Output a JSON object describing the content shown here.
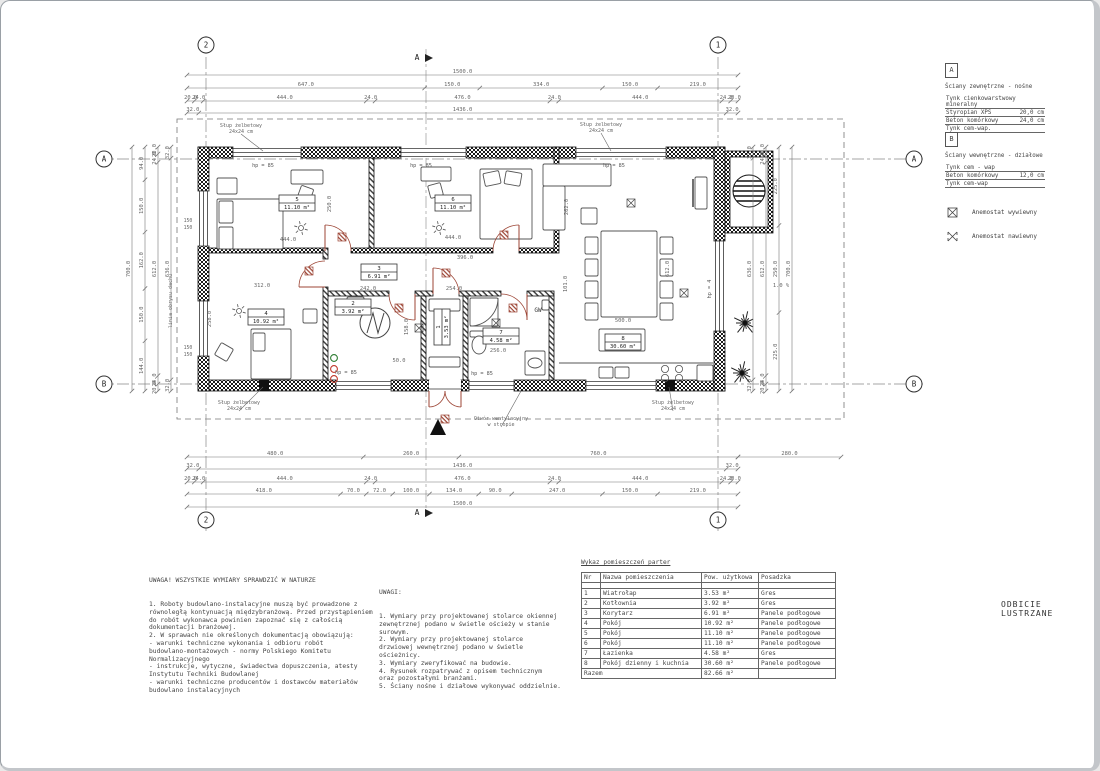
{
  "sheet": {
    "mirror_note": "ODBICIE LUSTRZANE"
  },
  "axes": {
    "col_left": "2",
    "col_right": "1",
    "row_top": "A",
    "row_bottom": "B",
    "section": "A"
  },
  "legend": {
    "wall_type_a": {
      "letter": "A",
      "title": "Ściany zewnętrzne - nośne",
      "layers": [
        {
          "name": "Tynk cienkowarstwowy mineralny",
          "value": ""
        },
        {
          "name": "Styropian XPS",
          "value": "20,0 cm"
        },
        {
          "name": "Beton komórkowy",
          "value": "24,0 cm"
        },
        {
          "name": "Tynk cem-wap.",
          "value": ""
        }
      ]
    },
    "wall_type_b": {
      "letter": "B",
      "title": "Ściany wewnętrzne - działowe",
      "layers": [
        {
          "name": "Tynk cem - wap",
          "value": ""
        },
        {
          "name": "Beton komórkowy",
          "value": "12,0 cm"
        },
        {
          "name": "Tynk cem-wap",
          "value": ""
        }
      ]
    },
    "symbols": [
      {
        "label": "Anemostat wywiewny"
      },
      {
        "label": "Anemostat nawiewny"
      }
    ]
  },
  "dims": {
    "top": [
      [
        "1500.0"
      ],
      [
        "647.0",
        "150.0",
        "334.0",
        "150.0",
        "219.0"
      ],
      [
        "20.0",
        "24.0",
        "444.0",
        "24.0",
        "476.0",
        "24.0",
        "444.0",
        "24.0",
        "20.0"
      ],
      [
        "32.0",
        "1436.0",
        "32.0"
      ]
    ],
    "bottom": [
      [
        "480.0",
        "260.0",
        "760.0"
      ],
      [
        "32.0",
        "1436.0",
        "32.0"
      ],
      [
        "20.0",
        "24.0",
        "444.0",
        "24.0",
        "476.0",
        "24.0",
        "444.0",
        "24.0",
        "20.0"
      ],
      [
        "418.0",
        "70.0",
        "72.0",
        "100.0",
        "134.0",
        "90.0",
        "247.0",
        "150.0",
        "219.0"
      ],
      [
        "1500.0"
      ]
    ],
    "bottom_ext": [
      "280.0"
    ],
    "left": [
      [
        "700.0"
      ],
      [
        "94.0",
        "150.0",
        "162.0",
        "150.0",
        "144.0"
      ],
      [
        "20.0",
        "24.0",
        "612.0",
        "24.0",
        "20.0"
      ],
      [
        "32.0",
        "636.0",
        "32.0"
      ]
    ],
    "right": [
      [
        "32.0",
        "636.0",
        "32.0"
      ],
      [
        "20.0",
        "24.0",
        "612.0",
        "24.0",
        "20.0"
      ],
      [
        "225.0",
        "250.0",
        "225.0"
      ],
      [
        "700.0"
      ]
    ]
  },
  "interior_dims": [
    "444.0",
    "250.0",
    "444.0",
    "396.0",
    "312.0",
    "258.0",
    "242.0",
    "254.0",
    "158.0",
    "256.0",
    "262.0",
    "612.0",
    "101.0",
    "500.0",
    "50.0"
  ],
  "hp_labels": [
    "hp = 85",
    "hp = 85",
    "hp = 85",
    "hp = 85",
    "hp = 85",
    "hp = 4"
  ],
  "window_tags": [
    "150",
    "150",
    "150",
    "150"
  ],
  "callouts": {
    "column": [
      "Słup żelbetowy",
      "24x24 cm"
    ],
    "vent": [
      "Otwór wentylacyjny",
      "w stropie"
    ],
    "roof_line": "linia obrysu dachu",
    "slope": "1.0 %",
    "gas_water": "GW"
  },
  "notes_left": {
    "title": "UWAGA! WSZYSTKIE WYMIARY SPRAWDZIĆ W NATURZE",
    "lines": [
      "1. Roboty budowlano-instalacyjne muszą być prowadzone z",
      "równoległą kontynuacją międzybranżową. Przed przystąpieniem",
      "do robót wykonawca powinien zapoznać się z całością",
      "dokumentacji branżowej.",
      "2. W sprawach nie określonych dokumentacją obowiązują:",
      "- warunki techniczne wykonania i odbioru robót",
      "budowlano-montażowych - normy Polskiego Komitetu",
      "Normalizacyjnego",
      "- instrukcje, wytyczne, świadectwa dopuszczenia, atesty",
      "Instytutu Techniki Budowlanej",
      "- warunki techniczne producentów i dostawców materiałów",
      "budowlano instalacyjnych"
    ]
  },
  "notes_center": {
    "title": "UWAGI:",
    "lines": [
      "1. Wymiary przy projektowanej stolarce okiennej",
      "zewnętrznej podano w świetle ościeży w stanie",
      "surowym.",
      "2. Wymiary przy projektowanej stolarce",
      "drzwiowej wewnętrznej podano w świetle",
      "ościeżnicy.",
      "3. Wymiary zweryfikować na budowie.",
      "4. Rysunek rozpatrywać z opisem technicznym",
      "oraz pozostałymi branżami.",
      "5. Ściany nośne i działowe wykonywać oddzielnie."
    ]
  },
  "room_table": {
    "title": "Wykaz pomieszczeń parter",
    "headers": [
      "Nr",
      "Nazwa pomieszczenia",
      "Pow. użytkowa",
      "Posadzka"
    ],
    "rows": [
      [
        "1",
        "Wiatrołap",
        "3.53 m²",
        "Gres"
      ],
      [
        "2",
        "Kotłownia",
        "3.92 m²",
        "Gres"
      ],
      [
        "3",
        "Korytarz",
        "6.91 m²",
        "Panele podłogowe"
      ],
      [
        "4",
        "Pokój",
        "10.92 m²",
        "Panele podłogowe"
      ],
      [
        "5",
        "Pokój",
        "11.10 m²",
        "Panele podłogowe"
      ],
      [
        "6",
        "Pokój",
        "11.10 m²",
        "Panele podłogowe"
      ],
      [
        "7",
        "Łazienka",
        "4.58 m²",
        "Gres"
      ],
      [
        "8",
        "Pokój dzienny i kuchnia",
        "30.60 m²",
        "Panele podłogowe"
      ]
    ],
    "footer": [
      "Razem",
      "82.66 m²"
    ]
  }
}
